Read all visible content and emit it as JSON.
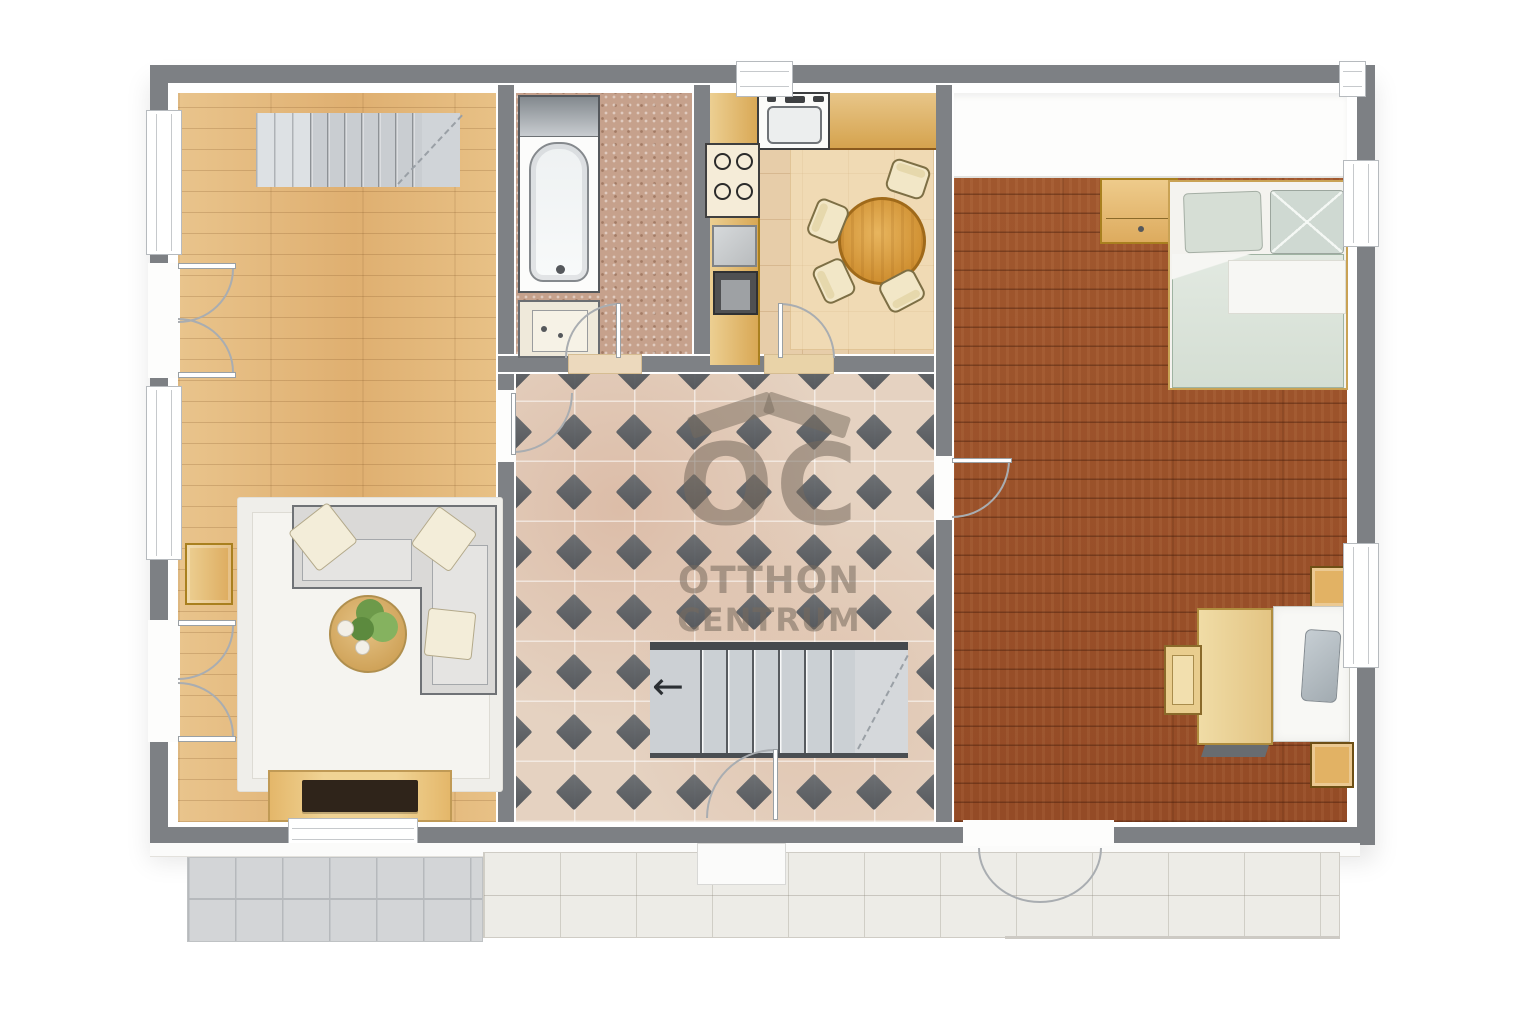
{
  "watermark": {
    "logo": "OC",
    "line1": "OTTHON",
    "line2": "CENTRUM"
  },
  "hall_stairs": {
    "direction_arrow": "←"
  },
  "palette": {
    "wall_gray": "#7d8084",
    "living_wood": "#e4b97e",
    "bedroom_wood": "#9e5530",
    "hall_tile_base": "#e5d2c1",
    "hall_tile_diamond": "#565b60",
    "bathroom_floor": "#c6a18c",
    "kitchen_floor": "#e7cda9",
    "kitchen_wood": "#d9a855",
    "terrace_tile": "#edece7",
    "terrace_path_gray": "#d3d5d7",
    "sofa_gray": "#dad9d7",
    "bed_duvet_green": "#dde6dd",
    "rug_white": "#f2f1ed",
    "dining_table_wood": "#d89a3c",
    "stair_gray": "#cbd0d4"
  },
  "rooms": [
    {
      "id": "living-room",
      "features": [
        "staircase-up",
        "double-doors",
        "sofa",
        "coffee-table",
        "plant",
        "rug",
        "side-table",
        "tv-console"
      ]
    },
    {
      "id": "bathroom",
      "features": [
        "bathtub",
        "washing-machine",
        "door"
      ]
    },
    {
      "id": "kitchen",
      "features": [
        "sink",
        "cooktop",
        "dishwasher",
        "oven",
        "dining-table",
        "four-chairs",
        "door"
      ]
    },
    {
      "id": "hallway",
      "features": [
        "diamond-tile-floor",
        "staircase-down",
        "entrance-door",
        "watermark"
      ]
    },
    {
      "id": "bedroom",
      "features": [
        "wardrobe-area",
        "double-bed",
        "nightstand",
        "desk",
        "chair",
        "single-bed",
        "cabinets",
        "terrace-doors"
      ]
    },
    {
      "id": "terrace",
      "features": [
        "tiled-patio",
        "gray-paved-path",
        "porch-step"
      ]
    }
  ]
}
